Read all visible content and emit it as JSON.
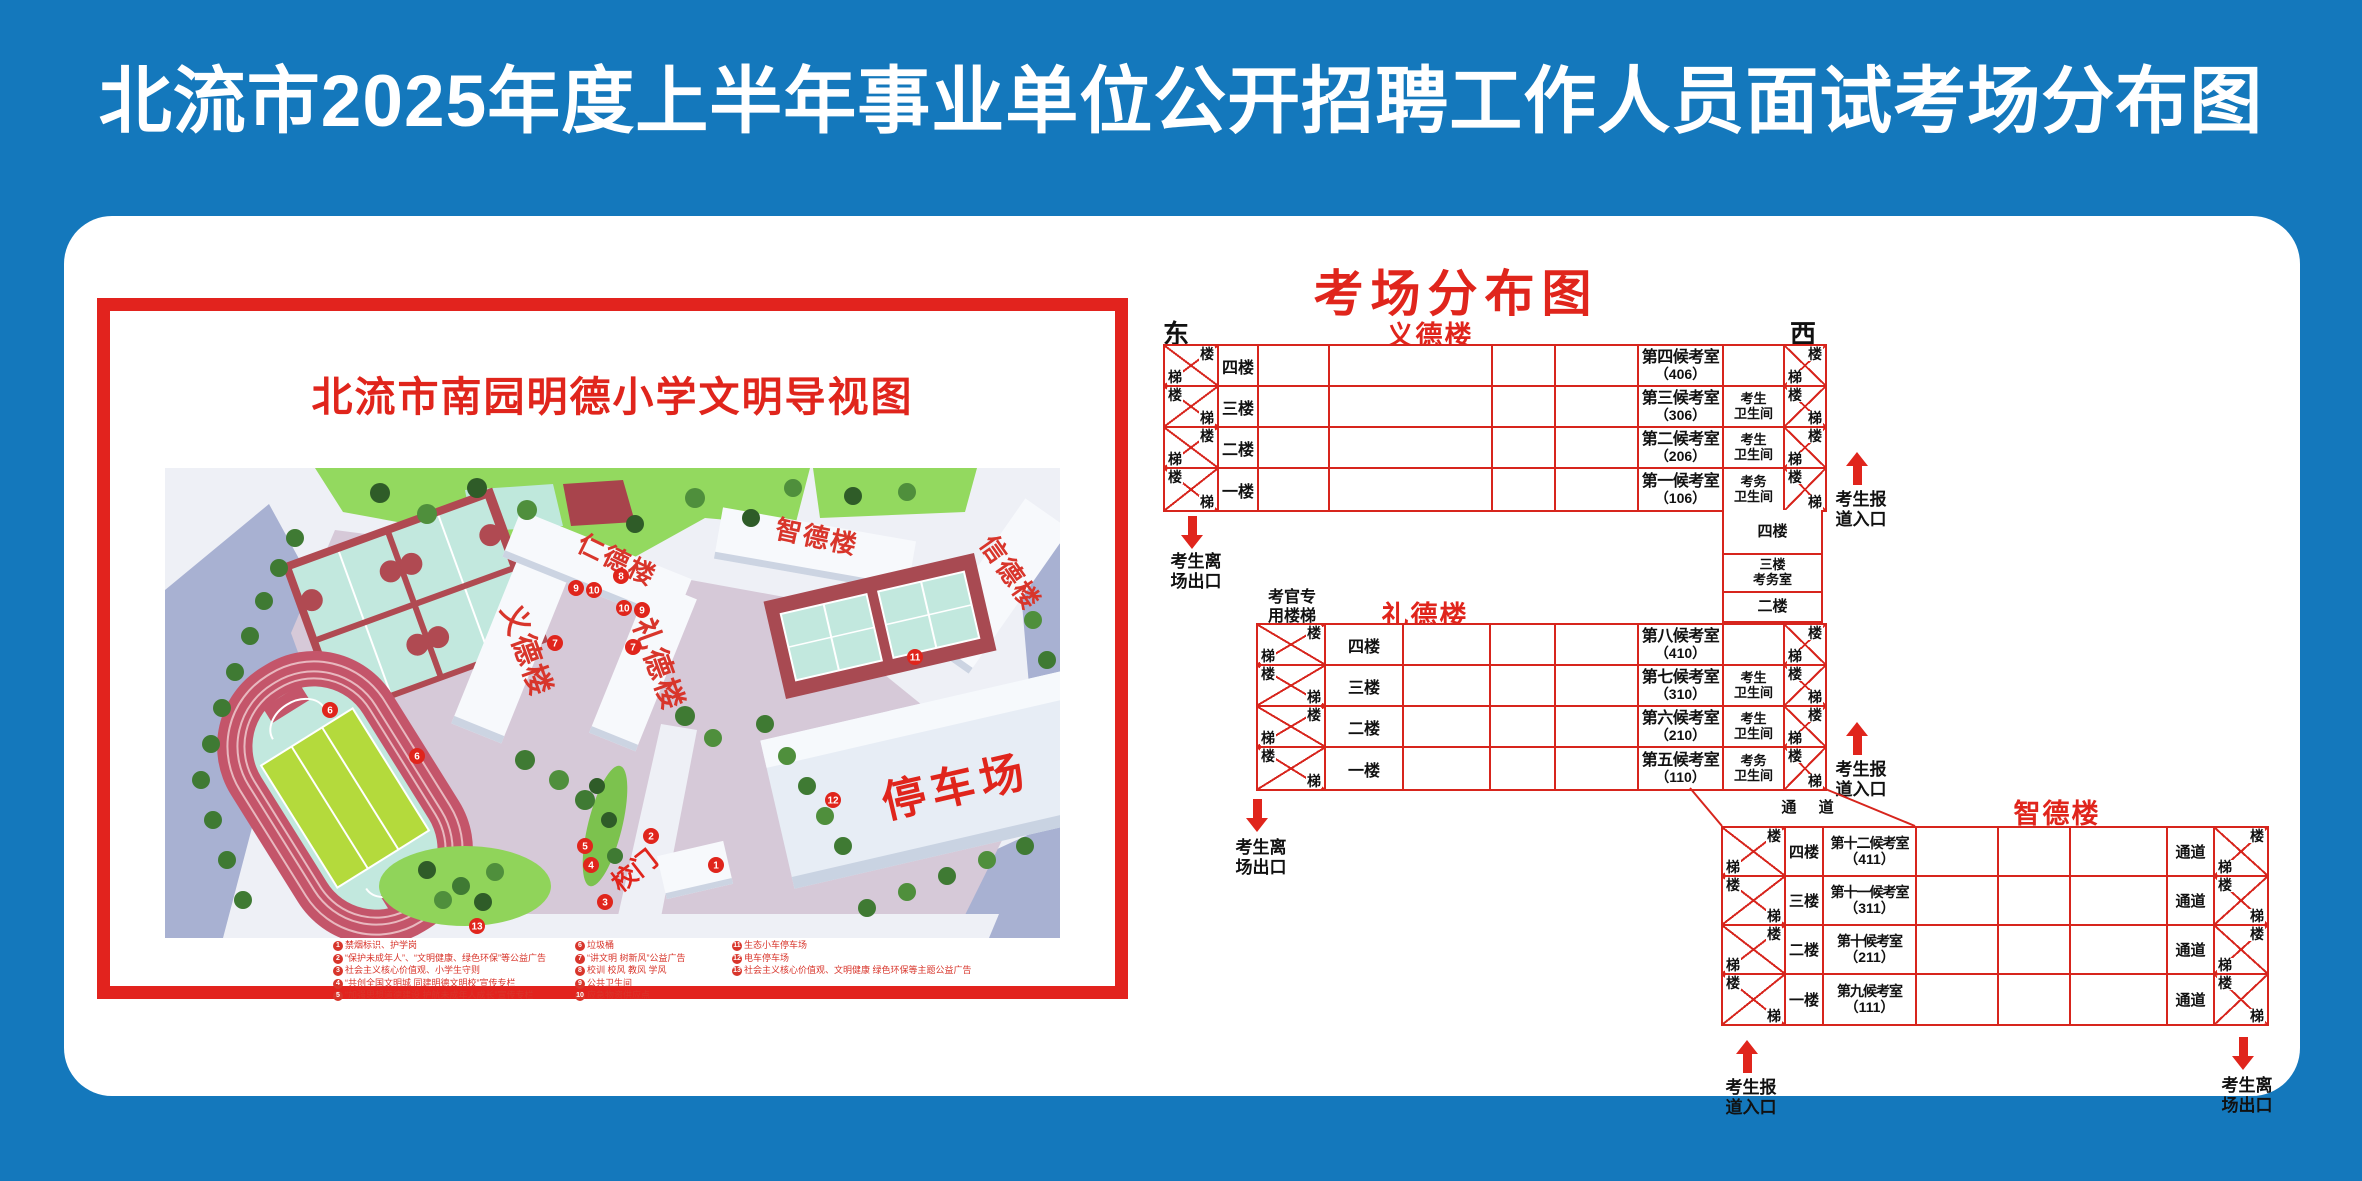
{
  "colors": {
    "background_blue": "#1478BC",
    "accent_red": "#E0251C",
    "grid_red": "#D7251D"
  },
  "banner": {
    "title": "北流市2025年度上半年事业单位公开招聘工作人员面试考场分布图"
  },
  "poster": {
    "title": "北流市南园明德小学文明导视图",
    "map": {
      "building_yide": "义德楼",
      "building_rende": "仁德楼",
      "building_lide": "礼德楼",
      "building_zhide": "智德楼",
      "building_xinde": "信德楼",
      "parking": "停车场",
      "gate": "校门",
      "markers": [
        "1",
        "2",
        "3",
        "4",
        "5",
        "6",
        "6",
        "7",
        "7",
        "8",
        "9",
        "10",
        "10",
        "9",
        "11",
        "12",
        "13"
      ]
    },
    "legend": {
      "items": [
        {
          "n": "1",
          "t": "禁烟标识、护学岗"
        },
        {
          "n": "2",
          "t": "“保护未成年人”、“文明健康、绿色环保”等公益广告"
        },
        {
          "n": "3",
          "t": "社会主义核心价值观、小学生守则"
        },
        {
          "n": "4",
          "t": "“共创全国文明城 同建明德文明校”宣传专栏"
        },
        {
          "n": "5",
          "t": "“加强思想道德建设 护航未成年人成长”宣传专栏"
        },
        {
          "n": "6",
          "t": "垃圾桶"
        },
        {
          "n": "7",
          "t": "“讲文明 树新风”公益广告"
        },
        {
          "n": "8",
          "t": "校训 校风 教风 学风"
        },
        {
          "n": "9",
          "t": "公共卫生间"
        },
        {
          "n": "10",
          "t": "应急物资供应点"
        },
        {
          "n": "11",
          "t": "生态小车停车场"
        },
        {
          "n": "12",
          "t": "电车停车场"
        },
        {
          "n": "13",
          "t": "社会主义核心价值观、文明健康 绿色环保等主题公益广告"
        }
      ]
    }
  },
  "diagram": {
    "title": "考场分布图",
    "east": "东",
    "west": "西",
    "stair_upper": "楼",
    "stair_lower": "梯",
    "exit_text": "考生离\n场出口",
    "entry_text": "考生报\n道入口",
    "corridor": "通 道",
    "connector": {
      "cells": [
        "四楼",
        "三楼\n考务室",
        "二楼"
      ]
    },
    "yide": {
      "name": "义德楼",
      "rows": [
        {
          "floor": "四楼",
          "room": "第四候考室",
          "no": "（406）",
          "wc": ""
        },
        {
          "floor": "三楼",
          "room": "第三候考室",
          "no": "（306）",
          "wc": "考生\n卫生间"
        },
        {
          "floor": "二楼",
          "room": "第二候考室",
          "no": "（206）",
          "wc": "考生\n卫生间"
        },
        {
          "floor": "一楼",
          "room": "第一候考室",
          "no": "（106）",
          "wc": "考务\n卫生间"
        }
      ]
    },
    "lide": {
      "name": "礼德楼",
      "examiner_stairs": "考官专\n用楼梯",
      "rows": [
        {
          "floor": "四楼",
          "room": "第八候考室",
          "no": "（410）",
          "wc": ""
        },
        {
          "floor": "三楼",
          "room": "第七候考室",
          "no": "（310）",
          "wc": "考生\n卫生间"
        },
        {
          "floor": "二楼",
          "room": "第六候考室",
          "no": "（210）",
          "wc": "考生\n卫生间"
        },
        {
          "floor": "一楼",
          "room": "第五候考室",
          "no": "（110）",
          "wc": "考务\n卫生间"
        }
      ]
    },
    "zhide": {
      "name": "智德楼",
      "rows": [
        {
          "floor": "四楼",
          "room": "第十二候考室",
          "no": "（411）",
          "aisle": "通道"
        },
        {
          "floor": "三楼",
          "room": "第十一候考室",
          "no": "（311）",
          "aisle": "通道"
        },
        {
          "floor": "二楼",
          "room": "第十候考室",
          "no": "（211）",
          "aisle": "通道"
        },
        {
          "floor": "一楼",
          "room": "第九候考室",
          "no": "（111）",
          "aisle": "通道"
        }
      ]
    }
  }
}
